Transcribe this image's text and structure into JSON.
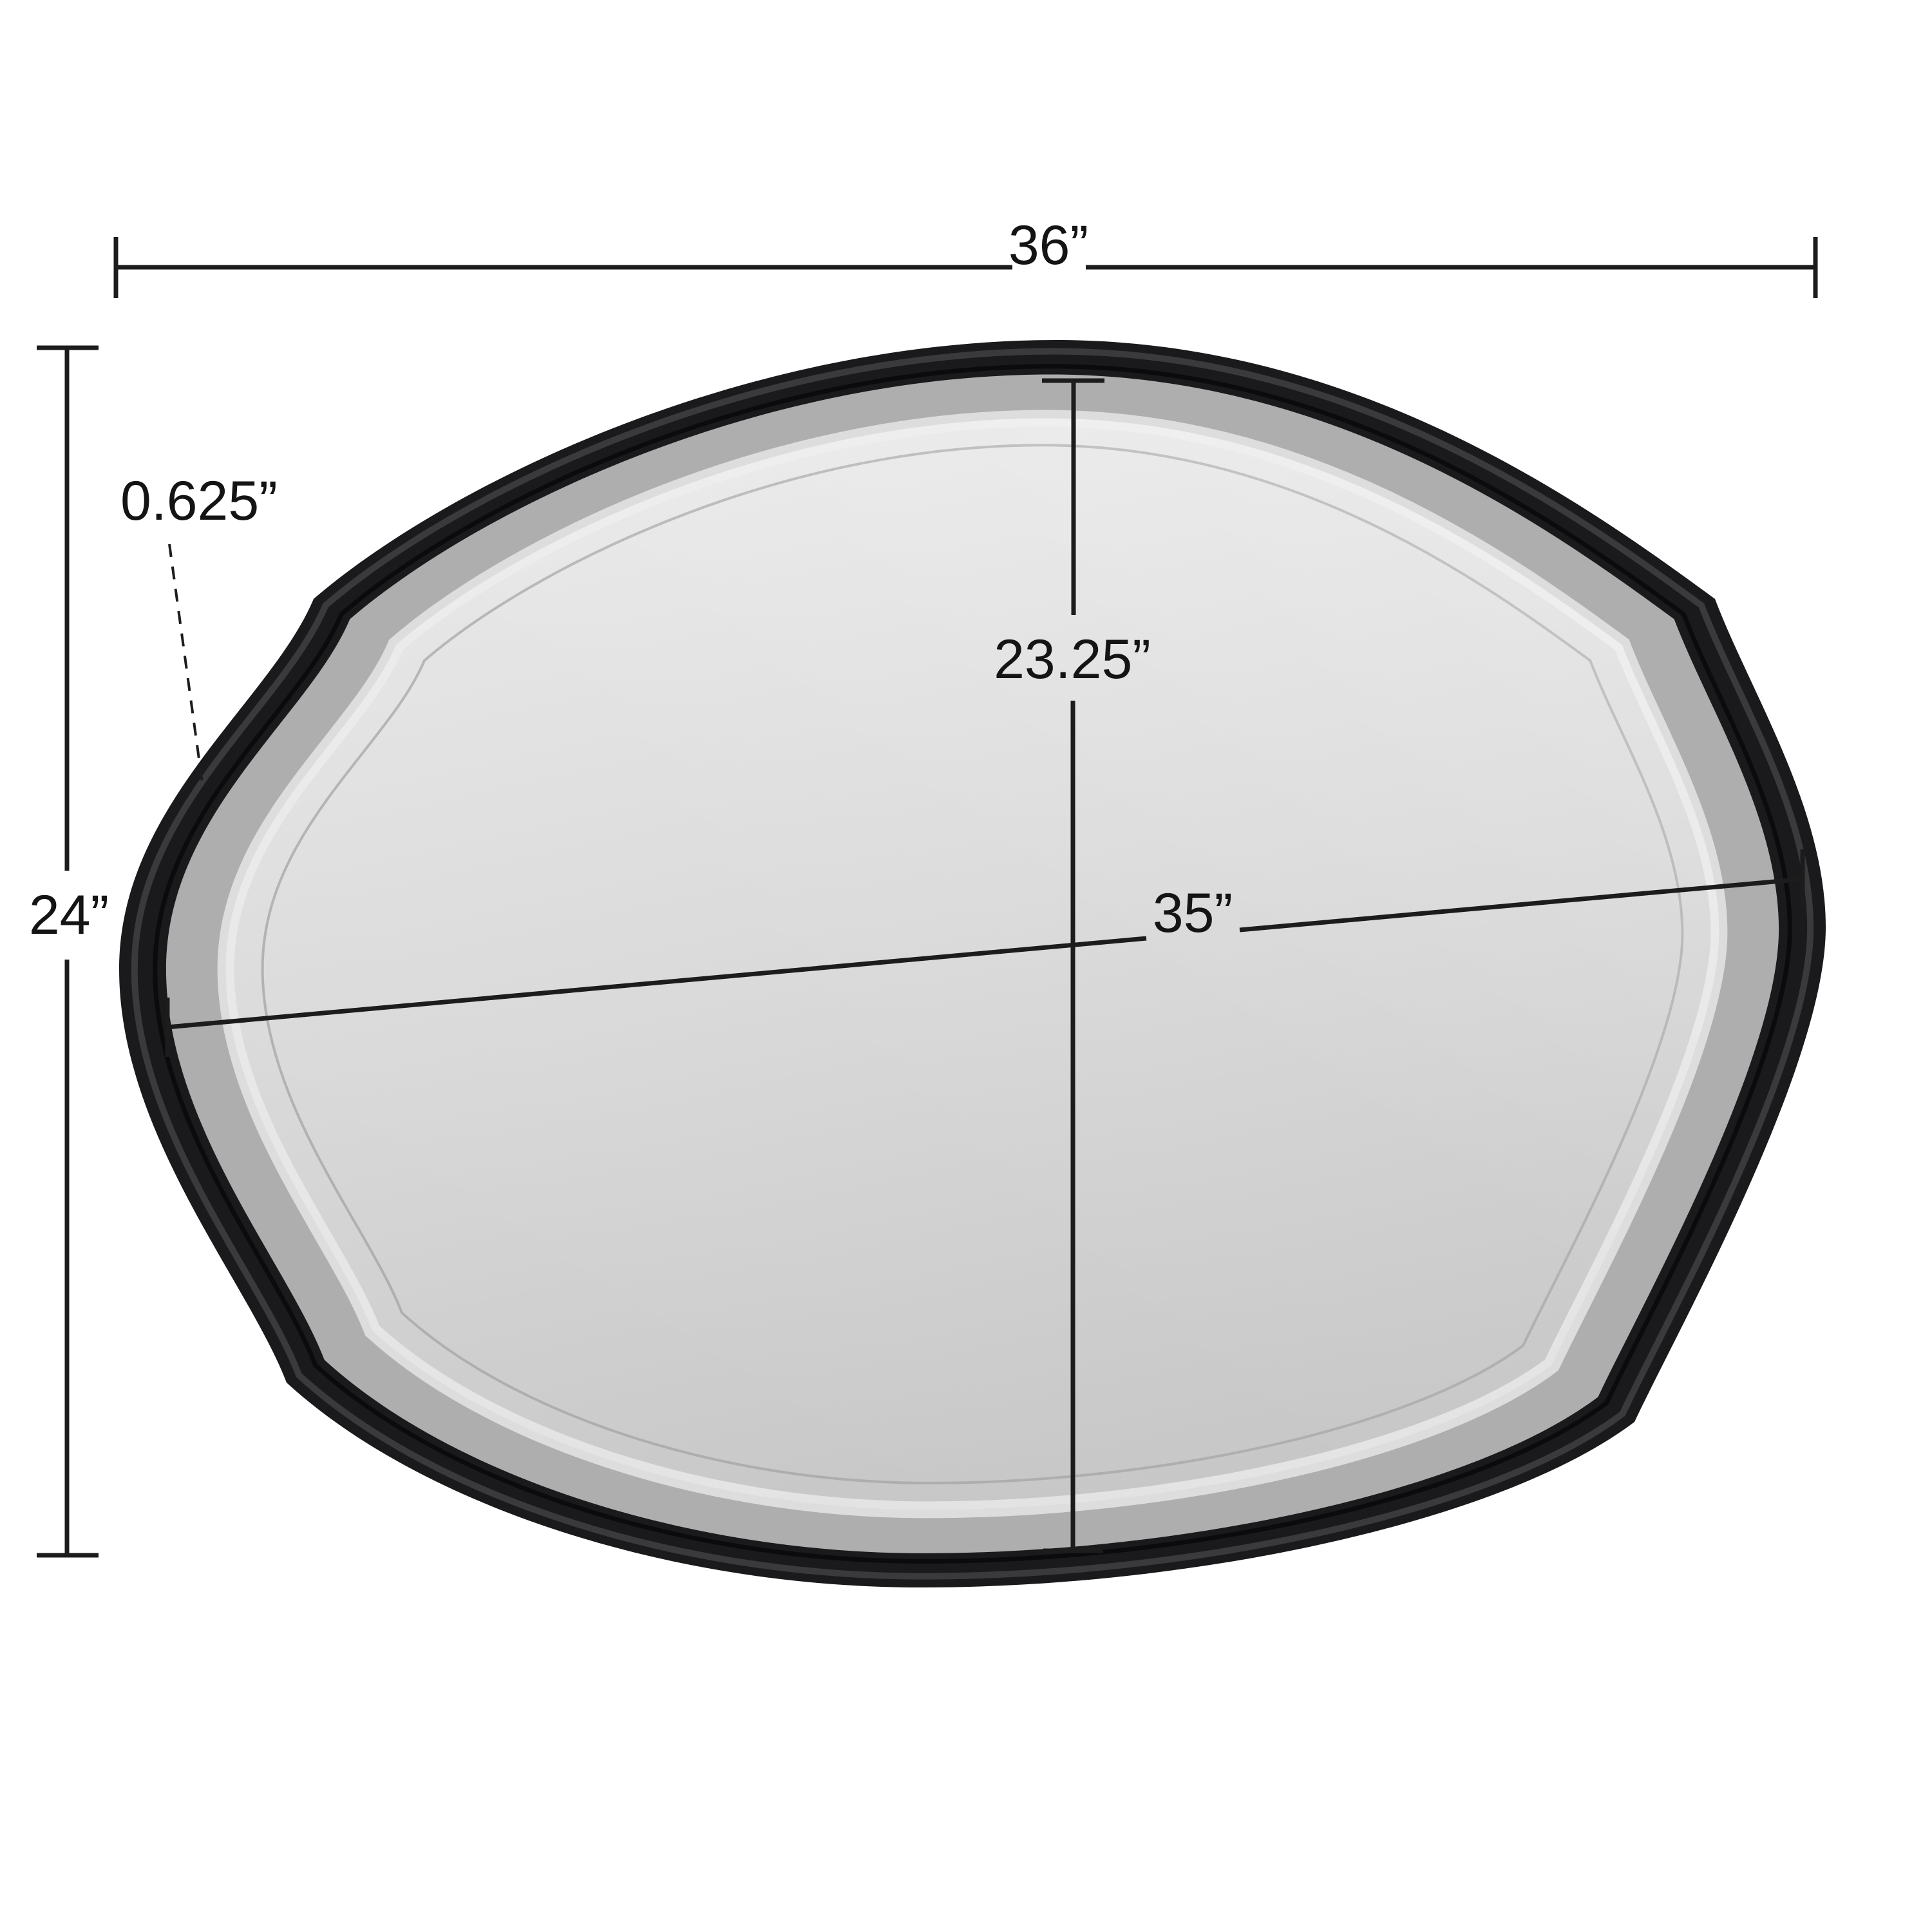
{
  "figure": {
    "type": "product-dimension-diagram",
    "product": "scalloped-oval-wall-mirror",
    "background": "#ffffff",
    "dimensions": {
      "outer_width": {
        "label": "36”",
        "value": 36,
        "unit": "in",
        "measures": "overall frame width"
      },
      "outer_height": {
        "label": "24”",
        "value": 24,
        "unit": "in",
        "measures": "overall frame height"
      },
      "frame_depth": {
        "label": "0.625”",
        "value": 0.625,
        "unit": "in",
        "measures": "frame thickness"
      },
      "inner_height": {
        "label": "23.25”",
        "value": 23.25,
        "unit": "in",
        "measures": "glass height"
      },
      "inner_width": {
        "label": "35”",
        "value": 35,
        "unit": "in",
        "measures": "glass width"
      }
    },
    "colors": {
      "frame": "#1a1a1d",
      "frame_highlight": "rgba(255,255,255,0.14)",
      "shadow_band": "#aeaeae",
      "glass_light": "#e9e9e9",
      "glass_mid": "#d9d9d9",
      "glass_dark": "#c6c6c6",
      "bevel_band": "#ececec",
      "bevel_line": "#a6a6a6",
      "dimension_line": "#1c1c1c"
    }
  }
}
